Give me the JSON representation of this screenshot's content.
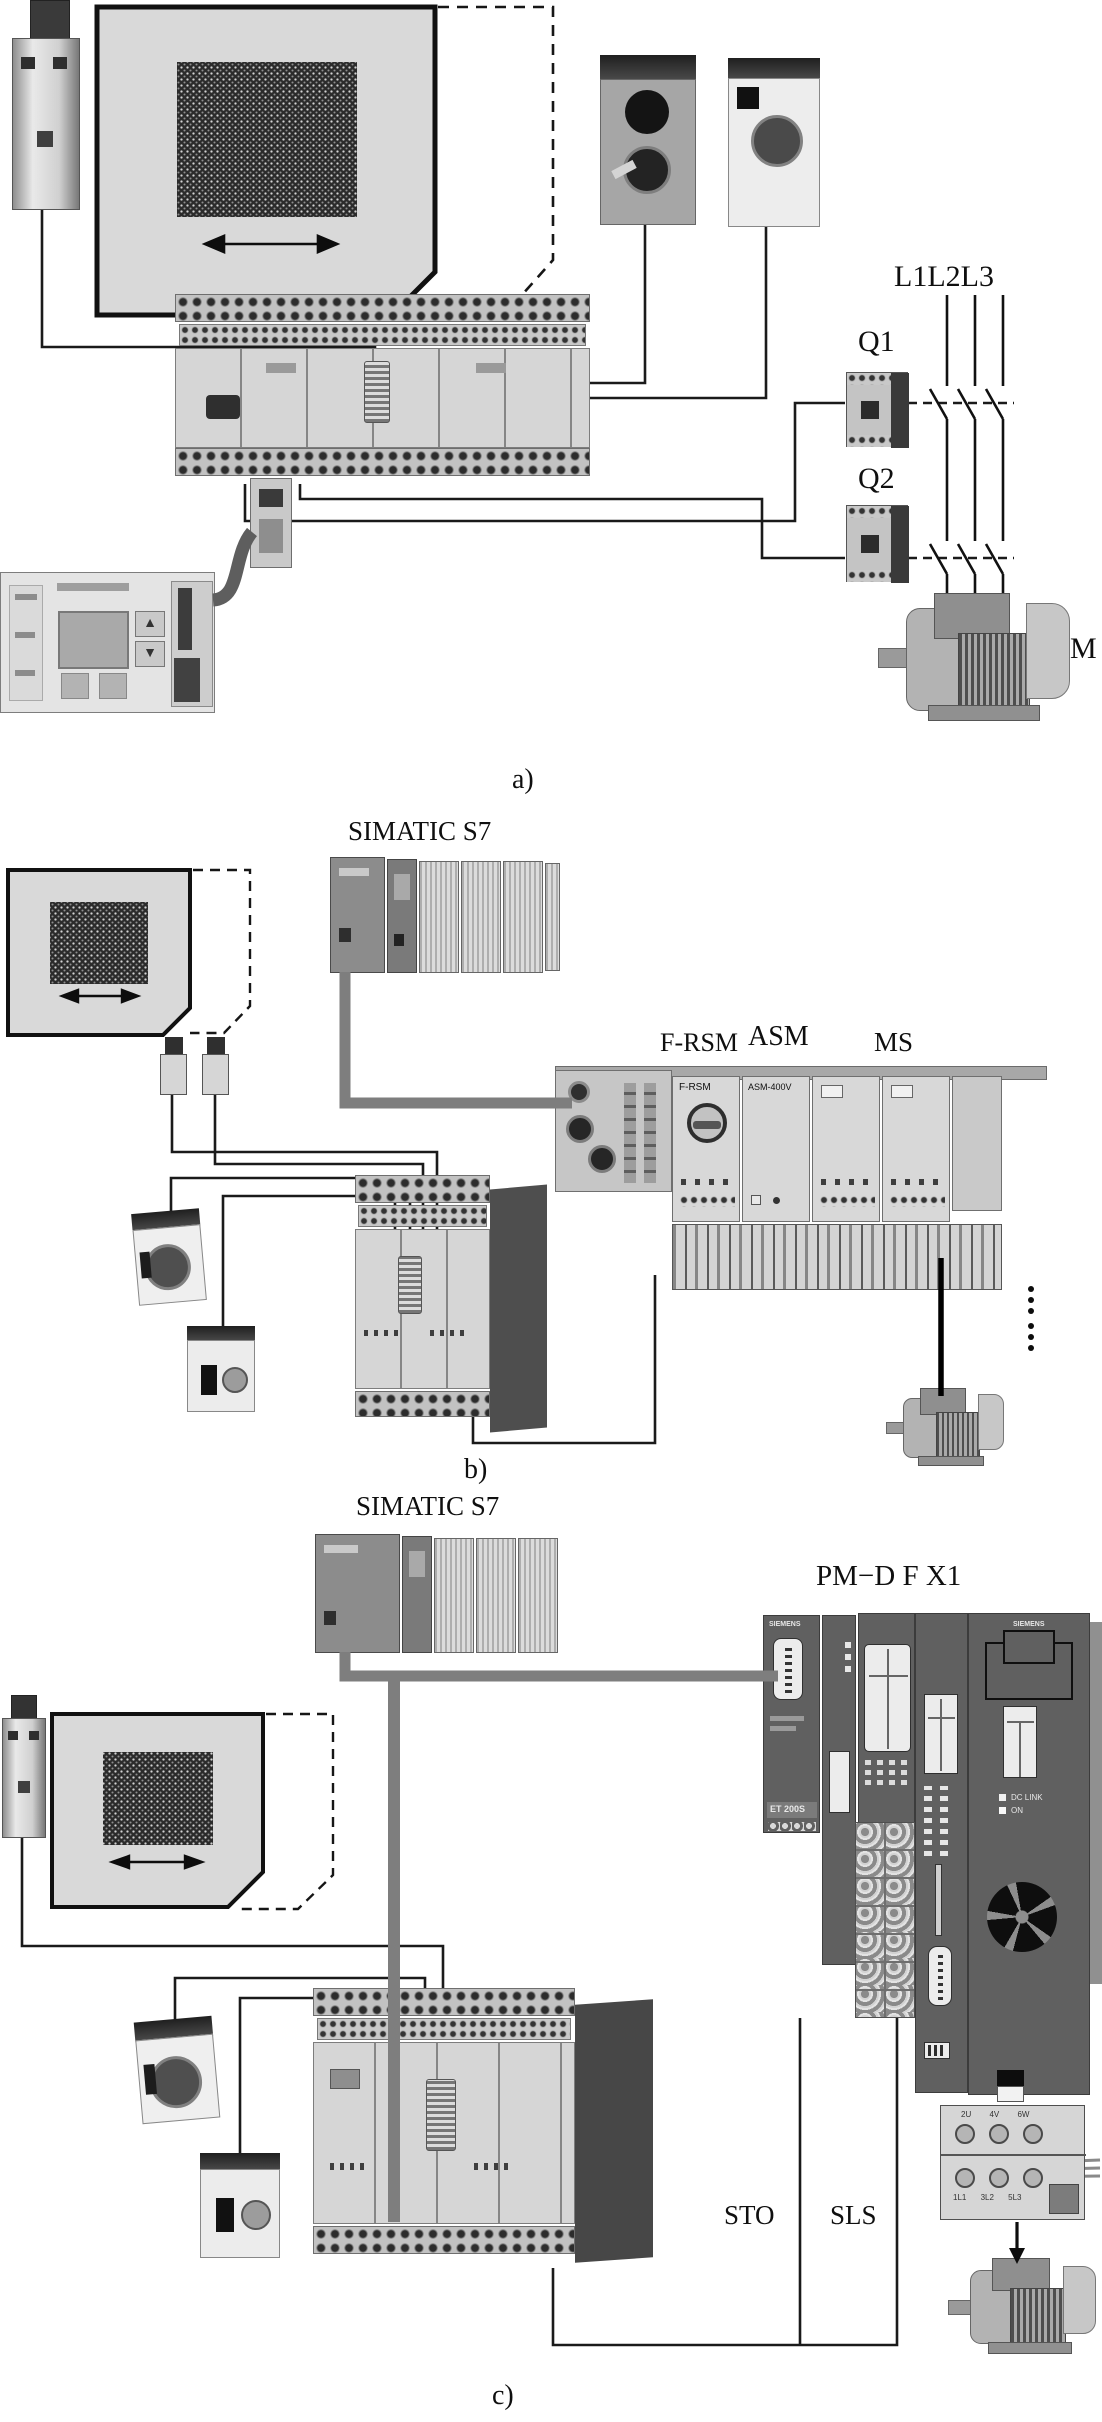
{
  "part_a": {
    "power_lines": "L1L2L3",
    "q1": "Q1",
    "q2": "Q2",
    "motor": "M",
    "caption": "a)"
  },
  "part_b": {
    "plc": "SIMATIC S7",
    "frsm": "F-RSM",
    "asm": "ASM",
    "ms": "MS",
    "frsm_face": "F-RSM",
    "asm_face": "ASM-400V",
    "caption": "b)"
  },
  "part_c": {
    "plc": "SIMATIC S7",
    "station": "PM−D F X1",
    "brand_im": "SIEMENS",
    "brand_drive": "SIEMENS",
    "im_model": "ET 200S",
    "led_dc_link": "DC LINK",
    "led_on": "ON",
    "sto": "STO",
    "sls": "SLS",
    "terminals_upper": "2U 4V 6W",
    "terminals_lower": "1L1 3L2 5L3",
    "caption": "c)"
  },
  "colors": {
    "wire": "#1a1a1a",
    "bus_gray": "#7e7e7e",
    "gate_fill": "#d9d9d9"
  }
}
